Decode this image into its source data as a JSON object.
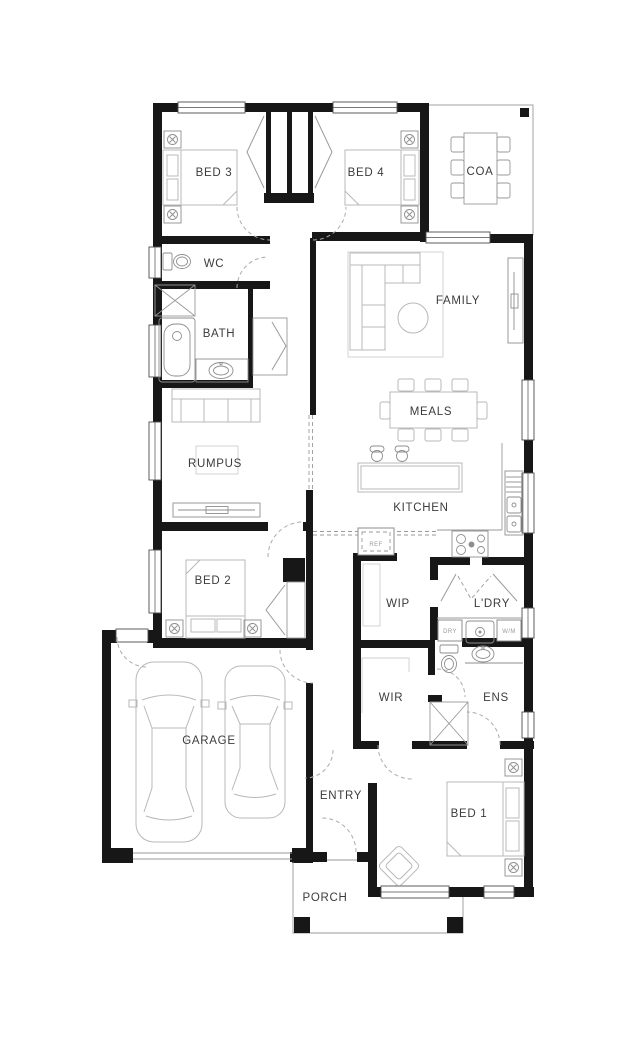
{
  "plan": {
    "rooms": {
      "bed3": "BED 3",
      "bed4": "BED 4",
      "coa": "COA",
      "wc": "WC",
      "family": "FAMILY",
      "bath": "BATH",
      "meals": "MEALS",
      "rumpus": "RUMPUS",
      "kitchen": "KITCHEN",
      "bed2": "BED 2",
      "wip": "WIP",
      "ldry": "L'DRY",
      "garage": "GARAGE",
      "wir": "WIR",
      "ens": "ENS",
      "entry": "ENTRY",
      "bed1": "BED 1",
      "porch": "PORCH"
    },
    "appliances": {
      "ref": "REF",
      "dry": "DRY",
      "wm": "W/M"
    },
    "palette": {
      "wall": "#171717",
      "furniture": "#b8b8b8",
      "fixture": "#8e8e8e",
      "door": "#ababab",
      "label": "#3c3c3c",
      "tiny": "#9b9b9b",
      "background": "#ffffff",
      "window": "#4d4d4d",
      "lightline": "#cfcfcf"
    }
  }
}
